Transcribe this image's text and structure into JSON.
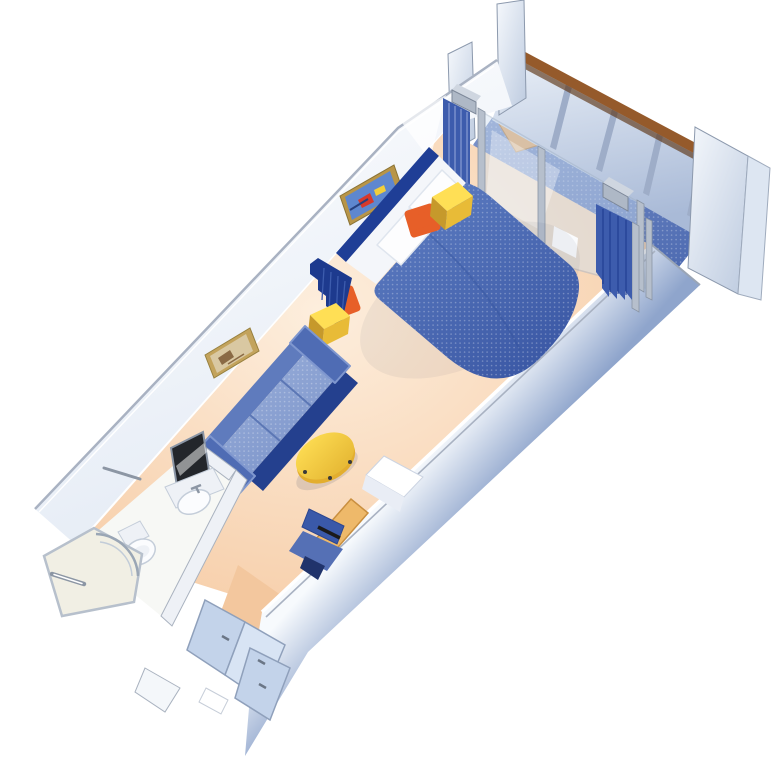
{
  "page": {
    "kind": "stateroom-floorplan-illustration",
    "background": "#ffffff"
  },
  "colors": {
    "background": "#ffffff",
    "floor_light": "#fdeedd",
    "floor_peach": "#f5c69c",
    "corridor_floor": "#f3c79e",
    "balcony_floor_light": "#7e95cb",
    "balcony_floor": "#4f6cb2",
    "wood_rail": "#955a2b",
    "wood_rail_dark": "#5c3414",
    "balustrade_light": "#e9eff7",
    "balustrade_dark": "#a9bad7",
    "support": "#9eadc8",
    "panel_light": "#f5f8fc",
    "panel_dark": "#bccadf",
    "panel_stroke": "#8c99ad",
    "panel_far": "#dde6f2",
    "bracket": "#aeb8c6",
    "bracket_top": "#cfd6e0",
    "glass": "#cfe0f0",
    "post_silver": "#b6bfcc",
    "curtain": "#3d5cad",
    "curtain_dark": "#1d3a8e",
    "curtain_pleat": "#93a8d8",
    "wall_face_white": "#ffffff",
    "wall_face_shade": "#e4ebf5",
    "trim": "#a9b2c2",
    "wall_right_light": "#f7fafd",
    "wall_right_dark": "#8fa5cc",
    "headboard": "#1f3e96",
    "sheet": "#f4f6fa",
    "bedspread_light": "#6080c4",
    "bedspread": "#3a57a4",
    "pillow": "#fdfdfe",
    "pillow_stroke": "#dfe5ee",
    "cushion_orange": "#e75f28",
    "table_yellow_top": "#ffdf55",
    "table_yellow_side": "#e8bb37",
    "table_yellow_dark": "#c6992b",
    "sofa_back": "#5f7bbd",
    "sofa_cushion_light": "#9db2dc",
    "sofa_cushion": "#7b93c9",
    "sofa_base": "#24408e",
    "sofa_arm": "#4f6cb4",
    "coffee_top": "#f6cf4a",
    "coffee_rim": "#e3ae2e",
    "desk_wood": "#eeb96a",
    "desk_edge": "#c98f3f",
    "cabinet_white": "#ffffff",
    "cabinet_shade": "#e9edf5",
    "chair_blue": "#3a59a9",
    "chair_seat": "#5570b5",
    "chair_dark": "#20336b",
    "bath_floor": "#f7f8f5",
    "bath_wall": "#eef1f6",
    "bath_trim": "#a9b2bf",
    "fixture_white": "#fbfcfe",
    "fixture_stroke": "#c4cdd9",
    "mirror_dark": "#23262b",
    "metal": "#8c96a4",
    "deck_chair": "#e2a768",
    "deck_chair_dark": "#cf8f4e",
    "deck_table": "#daa05c",
    "deck_table_side": "#b27a3e",
    "closet_panel": "#c3d3ea",
    "closet_panel_light": "#d8e4f4",
    "closet_stroke": "#8fa0bb",
    "handle": "#6b7686",
    "shadow": "#1c2c54",
    "frame_gold": "#b89548",
    "art1_bg": "#5e87cf",
    "art_red": "#d6392c",
    "art_yellow": "#f2cf3a",
    "art_navy": "#27407e",
    "frame2_gold": "#c3a35c",
    "art2_bg": "#d9c8a2",
    "art2_brown": "#8a6a45"
  },
  "scene": {
    "rooms": [
      "balcony",
      "sleeping-area",
      "sitting-area",
      "bathroom",
      "entry-corridor"
    ],
    "objects": [
      "balustrade-with-wood-rail",
      "balcony-divider-left",
      "balcony-divider-right",
      "deck-chair",
      "deck-table",
      "sliding-glass-door",
      "privacy-curtains",
      "queen-bed",
      "headboard",
      "pillows",
      "orange-bolsters",
      "nightstand",
      "wall-art-abstract",
      "wall-art-beach",
      "room-divider-curtain",
      "side-table",
      "sofa",
      "coffee-table",
      "desk",
      "minibar-cabinet",
      "desk-chair",
      "vanity-mirror",
      "sink",
      "toilet",
      "shower",
      "grab-bar",
      "towel-bar",
      "wardrobe-closet",
      "entry-door"
    ]
  }
}
